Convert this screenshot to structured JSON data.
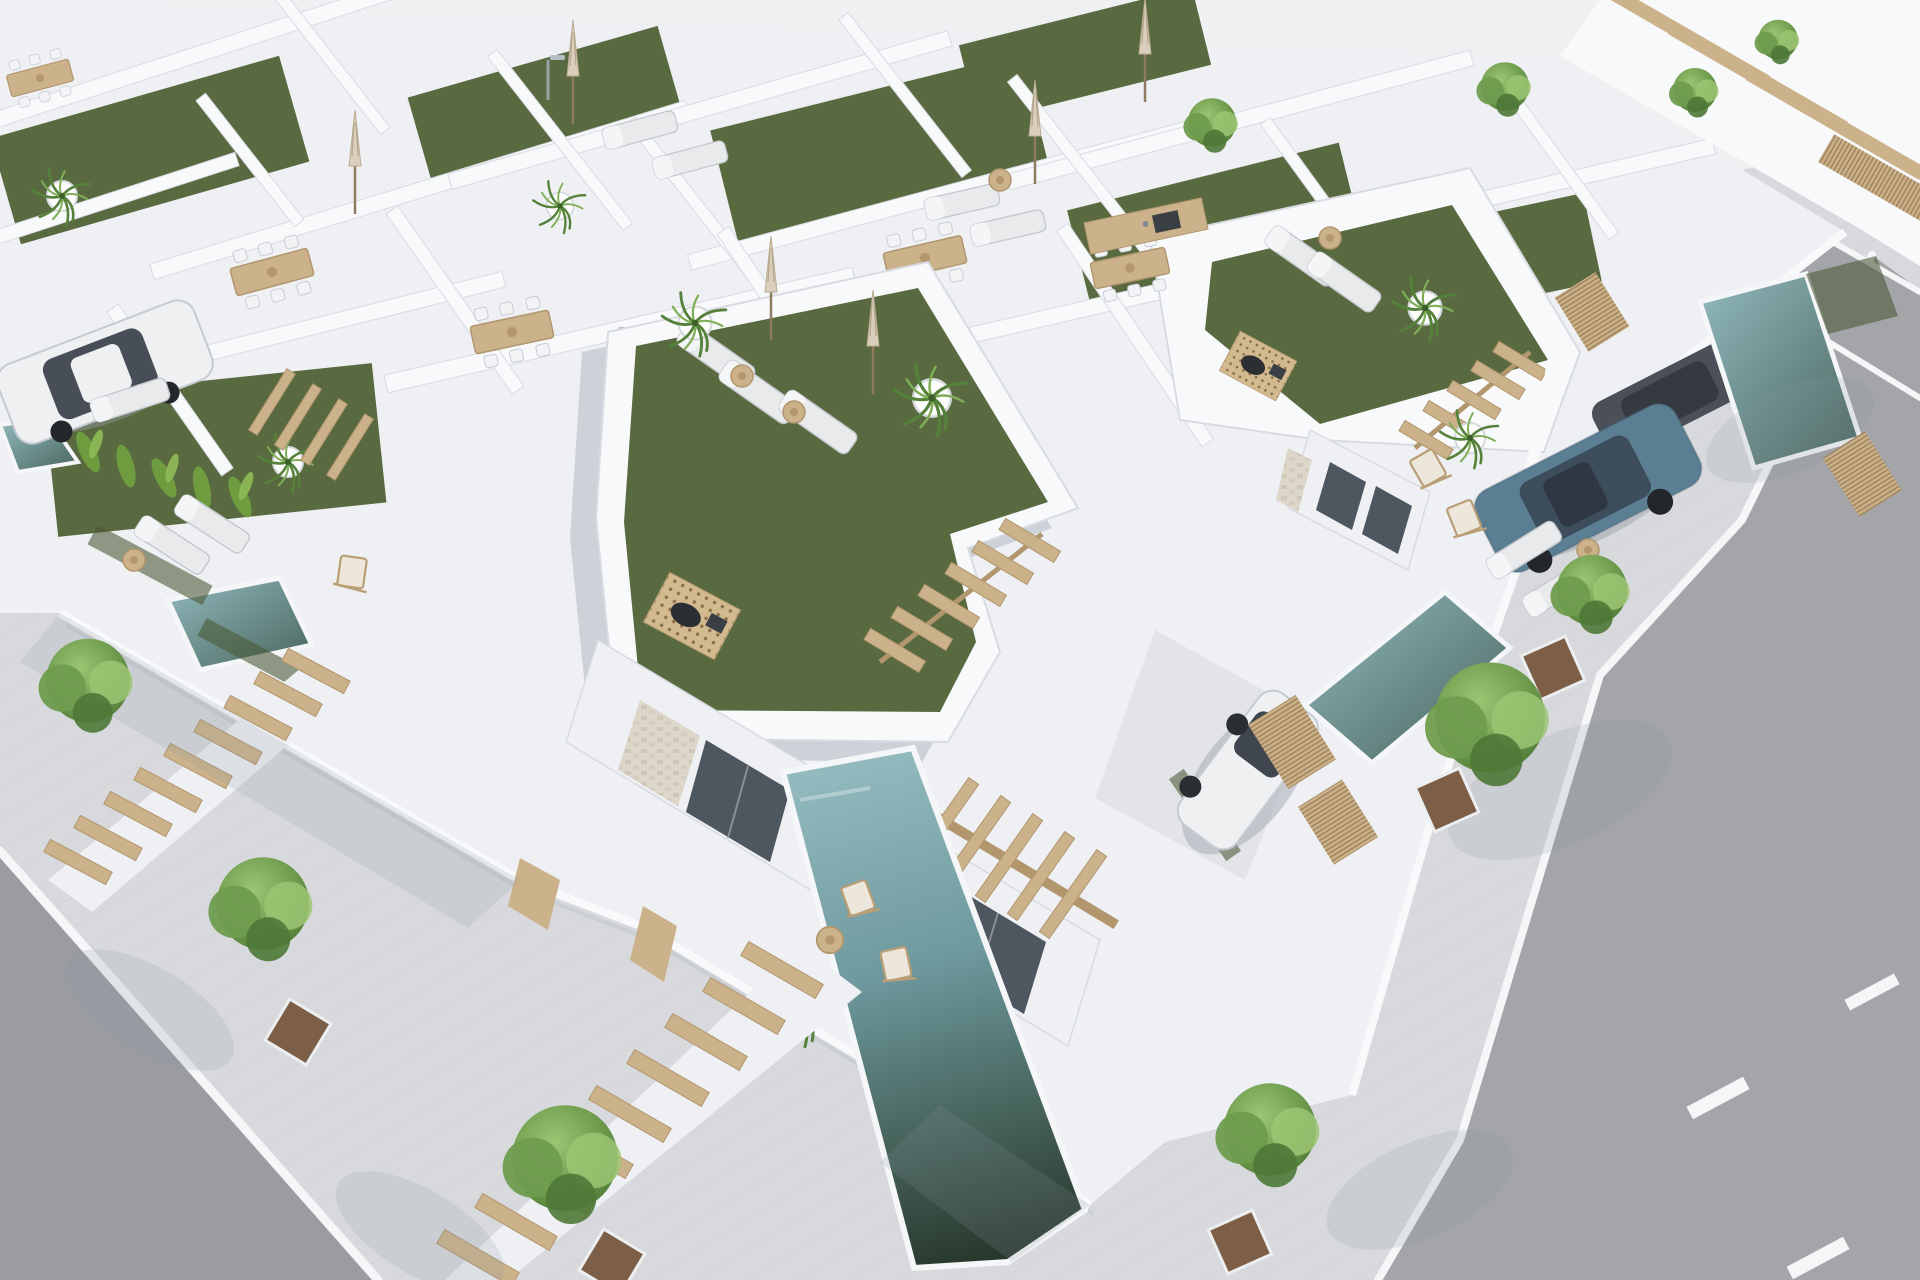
{
  "scene": {
    "type": "aerial-architectural-render",
    "view": "diagonal bird's-eye view of a new-build residential development",
    "setting": "rows of white modern villas with artificial-turf roof terraces, private plunge pools, patios and tree-lined streets",
    "inventory": {
      "villas_visible": 12,
      "roof_terraces_with_turf": 8,
      "plunge_pools": 5,
      "streets": 3,
      "street_trees": 9,
      "parked_cars": [
        {
          "label": "white-sedan",
          "location": "left carport"
        },
        {
          "label": "white-hatchback",
          "location": "center driveway"
        },
        {
          "label": "blue-suv",
          "location": "right driveway"
        },
        {
          "label": "dark-gray-car",
          "location": "behind right wall"
        }
      ],
      "sun_loungers": 14,
      "closed_parasols": 6,
      "outdoor_dining_sets": 6,
      "wooden_staircases": 3,
      "pergolas": 3,
      "fire_pit_decks": 2,
      "rooftop_showers": 2,
      "lane_markings": "white dashes on right street",
      "people": 0,
      "visible_text": ""
    }
  },
  "palette": {
    "base": "#eef0f2",
    "wallLit": "#f8f9fb",
    "wallSoft": "#eef0f3",
    "wallShade": "#d8dbe1",
    "wallDark": "#c3c8d1",
    "shadow": "#8a93a3",
    "turf": "#5a6a40",
    "turfDark": "#49583596",
    "turfDeep": "#495835",
    "asphalt": "#a3a5a9",
    "asphaltDark": "#9a9ca1",
    "sidewalk": "#d8d9dc",
    "curb": "#f5f6f7",
    "poolLight": "#93babe",
    "poolMid": "#6f9aa0",
    "poolDeep": "#47645c",
    "poolDarkest": "#263429",
    "wood": "#ccb28a",
    "woodDark": "#b1966e",
    "treeLight": "#9cc573",
    "treeMid": "#6f9c4e",
    "treeDark": "#4e7836",
    "trunk": "#8d7c62",
    "soil": "#7d5f47",
    "carWhite": "#eef0f2",
    "carBlue": "#5b7e92",
    "carBlueDark": "#3d4d5c",
    "carGray": "#4b5058",
    "glass": "#4e565f",
    "stone": "#ded8cb"
  }
}
